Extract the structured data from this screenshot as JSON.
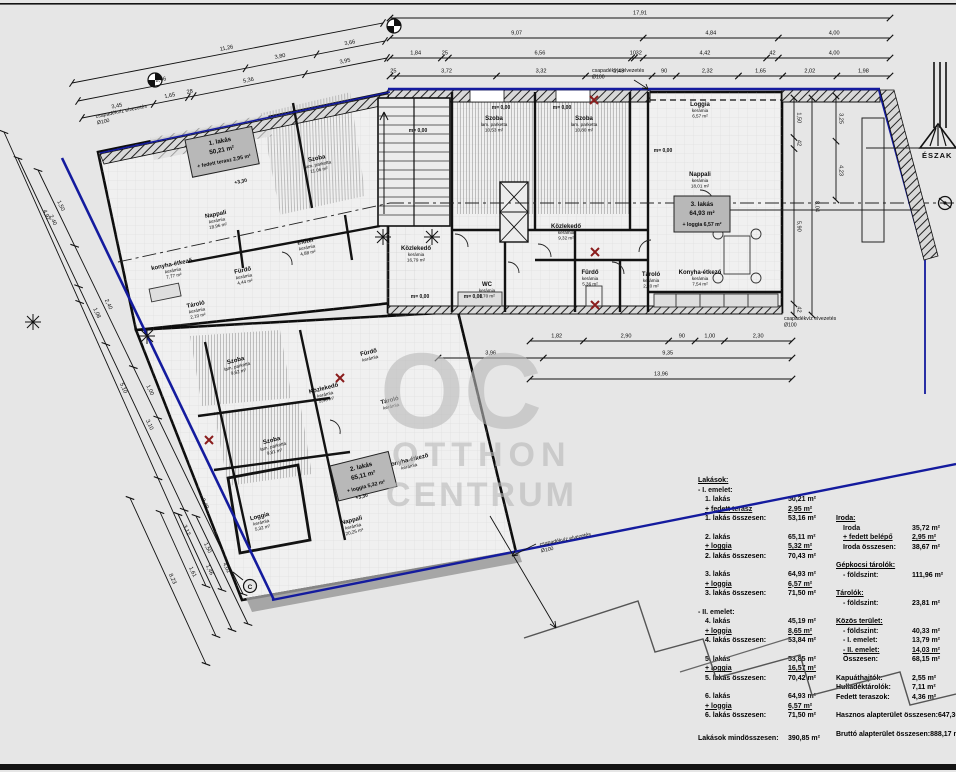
{
  "colors": {
    "boundary_blue": "#141b9e",
    "wall_black": "#111111",
    "marker_red": "#8a1d1d",
    "watermark_gray": "#b9b9b9",
    "label_box_gray": "#b8b8b8"
  },
  "compass": {
    "label": "ÉSZAK"
  },
  "watermark": {
    "big": "OC",
    "line1": "OTTHON",
    "line2": "CENTRUM"
  },
  "notes": {
    "drain_line1": "csapadékvíz elvezetés",
    "drain_line2": "Ø100"
  },
  "markers": {
    "section": "C"
  },
  "levels": [
    "m= 0,00",
    "m= 0,00",
    "m= 0,00",
    "m= 0,00",
    "m= 0,00",
    "m= 0,00",
    "+3,30",
    "+3,30"
  ],
  "apartments": [
    {
      "name": "1. lakás",
      "area": "50,21 m²",
      "extra": "+ fedett terasz 2,95 m²"
    },
    {
      "name": "2. lakás",
      "area": "65,11 m²",
      "extra": "+ loggia 5,32 m²"
    },
    {
      "name": "3. lakás",
      "area": "64,93 m²",
      "extra": "+ loggia 6,57 m²"
    }
  ],
  "rooms": [
    {
      "name": "Szoba",
      "sub": "lam. parketta",
      "area": "10,53 m²"
    },
    {
      "name": "Szoba",
      "sub": "lam. parketta",
      "area": "10,80 m²"
    },
    {
      "name": "Loggia",
      "sub": "kerámia",
      "area": "6,57 m²"
    },
    {
      "name": "Nappali",
      "sub": "kerámia",
      "area": "18,01 m²"
    },
    {
      "name": "Közlekedő",
      "sub": "kerámia",
      "area": "9,32 m²"
    },
    {
      "name": "Közlekedő",
      "sub": "kerámia",
      "area": "16,79 m²"
    },
    {
      "name": "Fürdő",
      "sub": "kerámia",
      "area": "5,36 m²"
    },
    {
      "name": "WC",
      "sub": "kerámia",
      "area": "1,70 m²"
    },
    {
      "name": "Tároló",
      "sub": "kerámia",
      "area": "2,10 m²"
    },
    {
      "name": "Konyha-étkező",
      "sub": "kerámia",
      "area": "7,54 m²"
    },
    {
      "name": "Nappali",
      "sub": "kerámia",
      "area": "18,96 m²"
    },
    {
      "name": "Szoba",
      "sub": "lam. parketta",
      "area": "11,06 m²"
    },
    {
      "name": "konyha-étkező",
      "sub": "kerámia",
      "area": "7,77 m²"
    },
    {
      "name": "Fürdő",
      "sub": "kerámia",
      "area": "4,44 m²"
    },
    {
      "name": "Előtér",
      "sub": "kerámia",
      "area": "4,88 m²"
    },
    {
      "name": "Tároló",
      "sub": "kerámia",
      "area": "2,10 m²"
    },
    {
      "name": "Szoba",
      "sub": "lam. parketta",
      "area": "9,62 m²"
    },
    {
      "name": "Szoba",
      "sub": "lam. parketta",
      "area": "9,81 m²"
    },
    {
      "name": "Közlekedő",
      "sub": "kerámia",
      "area": "5,46 m²"
    },
    {
      "name": "Fürdő",
      "sub": "kerámia",
      "area": ""
    },
    {
      "name": "Tároló",
      "sub": "kerámia",
      "area": ""
    },
    {
      "name": "Konyha-étkező",
      "sub": "kerámia",
      "area": ""
    },
    {
      "name": "Nappali",
      "sub": "kerámia",
      "area": "20,25 m²"
    },
    {
      "name": "Loggia",
      "sub": "kerámia",
      "area": "5,32 m²"
    }
  ],
  "dimensions": [
    {
      "values": [
        "17,91"
      ]
    },
    {
      "values": [
        "9,07",
        "4,84",
        "4,00"
      ]
    },
    {
      "values": [
        "1,84",
        "25",
        "6,56",
        "10",
        "32",
        "4,42",
        "42",
        "4,00"
      ]
    },
    {
      "values": [
        "25",
        "3,72",
        "3,32",
        "2,48",
        "90",
        "2,32",
        "1,65",
        "2,02",
        "1,98"
      ]
    },
    {
      "values": [
        "1,82",
        "2,90",
        "90",
        "1,00",
        "2,30"
      ]
    },
    {
      "values": [
        "3,96",
        "9,35"
      ]
    },
    {
      "values": [
        "13,96"
      ]
    },
    {
      "values": [
        "1,50",
        "42",
        "5,90",
        "42"
      ]
    },
    {
      "values": [
        "8,04"
      ]
    },
    {
      "values": [
        "3,25",
        "4,23"
      ]
    },
    {
      "values": [
        "11,26"
      ]
    },
    {
      "values": [
        "8,96",
        "3,80",
        "3,66"
      ]
    },
    {
      "values": [
        "3,45",
        "1,65",
        "28",
        "5,36",
        "3,95"
      ]
    },
    {
      "values": [
        "1,50",
        "2,40",
        "1,00",
        "3,49"
      ]
    },
    {
      "values": [
        "2,40",
        "1,08",
        "3,10",
        "1,50"
      ]
    },
    {
      "values": [
        "4,92",
        "5,10",
        "3,12"
      ]
    },
    {
      "values": [
        "1,61"
      ]
    },
    {
      "values": [
        "1,46"
      ]
    },
    {
      "values": [
        "4,02"
      ]
    },
    {
      "values": [
        "8,23"
      ]
    }
  ],
  "table": {
    "left": [
      {
        "l": "Lakások:",
        "b": 1,
        "u": 1
      },
      {
        "l": "- I. emelet:"
      },
      {
        "l": "1. lakás",
        "v": "50,21 m²",
        "i": 1
      },
      {
        "l": "+ fedett terasz",
        "v": "2,95 m²",
        "u": 1,
        "uv": 1,
        "i": 1
      },
      {
        "l": "1. lakás összesen:",
        "v": "53,16 m²",
        "b": 1,
        "i": 1
      },
      {
        "l": "2. lakás",
        "v": "65,11 m²",
        "i": 1,
        "g": 1
      },
      {
        "l": "+ loggia",
        "v": "5,32 m²",
        "u": 1,
        "uv": 1,
        "i": 1
      },
      {
        "l": "2. lakás összesen:",
        "v": "70,43 m²",
        "b": 1,
        "i": 1
      },
      {
        "l": "3. lakás",
        "v": "64,93 m²",
        "i": 1,
        "g": 1
      },
      {
        "l": "+ loggia",
        "v": "6,57 m²",
        "u": 1,
        "uv": 1,
        "i": 1
      },
      {
        "l": "3. lakás összesen:",
        "v": "71,50 m²",
        "b": 1,
        "i": 1
      },
      {
        "l": "- II. emelet:",
        "g": 1
      },
      {
        "l": "4. lakás",
        "v": "45,19 m²",
        "i": 1
      },
      {
        "l": "+ loggia",
        "v": "8,65 m²",
        "u": 1,
        "uv": 1,
        "i": 1
      },
      {
        "l": "4. lakás összesen:",
        "v": "53,84 m²",
        "b": 1,
        "i": 1
      },
      {
        "l": "5. lakás",
        "v": "53,85 m²",
        "i": 1,
        "g": 1
      },
      {
        "l": "+ loggia",
        "v": "16,57 m²",
        "u": 1,
        "uv": 1,
        "i": 1
      },
      {
        "l": "5. lakás összesen:",
        "v": "70,42 m²",
        "b": 1,
        "i": 1
      },
      {
        "l": "6. lakás",
        "v": "64,93 m²",
        "i": 1,
        "g": 1
      },
      {
        "l": "+ loggia",
        "v": "6,57 m²",
        "u": 1,
        "uv": 1,
        "i": 1
      },
      {
        "l": "6. lakás összesen:",
        "v": "71,50 m²",
        "b": 1,
        "i": 1
      },
      {
        "l": "Lakások mindösszesen:",
        "v": "390,85 m²",
        "b": 1,
        "g2": 1
      }
    ],
    "right": [
      {
        "l": "Iroda:",
        "b": 1,
        "u": 1
      },
      {
        "l": "Iroda",
        "v": "35,72 m²",
        "i": 1
      },
      {
        "l": "+ fedett belépő",
        "v": "2,95 m²",
        "u": 1,
        "uv": 1,
        "i": 1
      },
      {
        "l": "Iroda összesen:",
        "v": "38,67 m²",
        "b": 1,
        "i": 1
      },
      {
        "l": "Gépkocsi tárolók:",
        "b": 1,
        "u": 1,
        "g": 1
      },
      {
        "l": "- földszint:",
        "v": "111,96 m²",
        "vb": 1,
        "i": 1
      },
      {
        "l": "Tárolók:",
        "b": 1,
        "u": 1,
        "g": 1
      },
      {
        "l": "- földszint:",
        "v": "23,81 m²",
        "vb": 1,
        "i": 1
      },
      {
        "l": "Közös terület:",
        "b": 1,
        "u": 1,
        "g": 1
      },
      {
        "l": "- földszint:",
        "v": "40,33 m²",
        "i": 1
      },
      {
        "l": "- I. emelet:",
        "v": "13,79 m²",
        "i": 1
      },
      {
        "l": "- II. emelet:",
        "v": "14,03 m²",
        "u": 1,
        "uv": 1,
        "i": 1
      },
      {
        "l": "Összesen:",
        "v": "68,15 m²",
        "b": 1,
        "i": 1
      },
      {
        "l": "Kapuáthajtók:",
        "v": "2,55 m²",
        "b": 1,
        "g": 1
      },
      {
        "l": "Hulladéktárolók:",
        "v": "7,11 m²",
        "b": 1
      },
      {
        "l": "Fedett teraszok:",
        "v": "4,36 m²",
        "b": 1
      },
      {
        "l": "Hasznos alapterület összesen:",
        "v": "647,36 m²",
        "b": 1,
        "g": 1
      },
      {
        "l": "Bruttó alapterület összesen:",
        "v": "888,17 m²",
        "b": 1,
        "g": 1
      }
    ]
  }
}
